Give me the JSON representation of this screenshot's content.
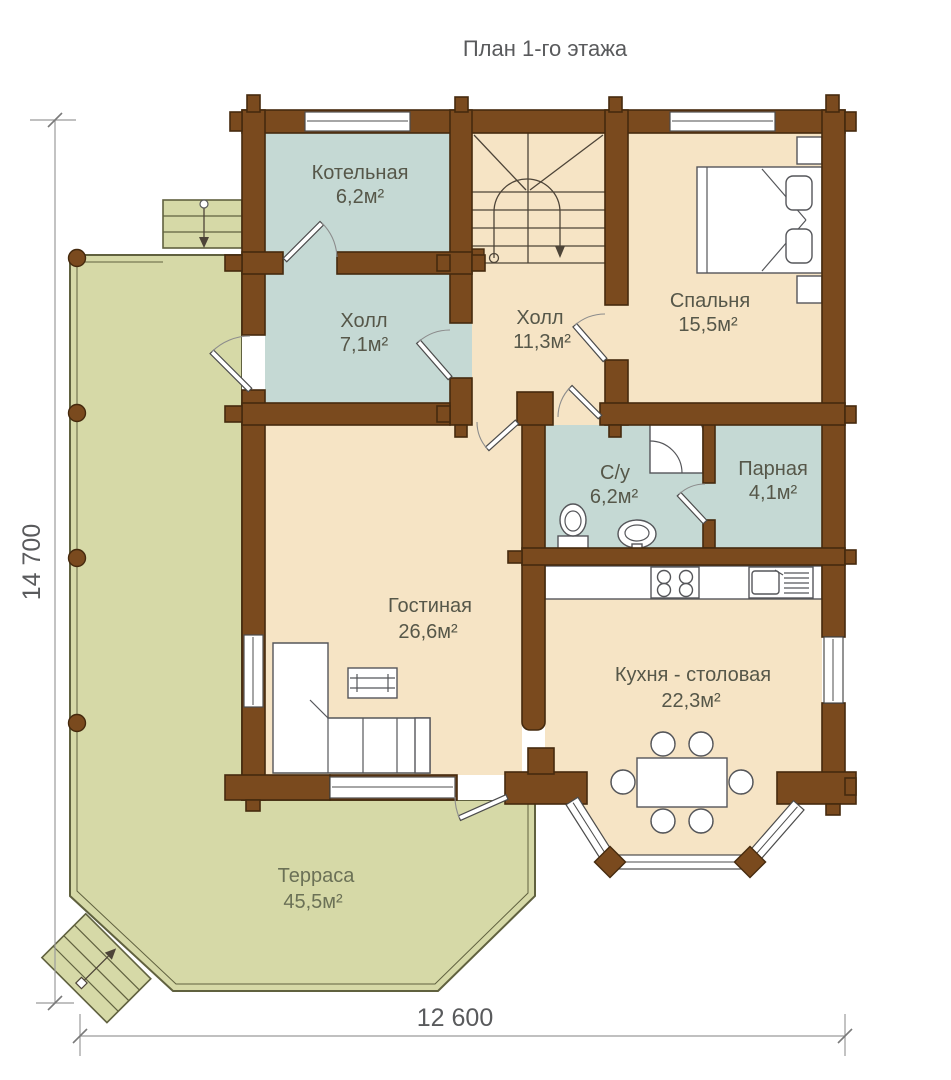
{
  "title": "План 1-го этажа",
  "rooms": [
    {
      "name": "Котельная",
      "area": "6,2м²"
    },
    {
      "name": "Холл",
      "area": "7,1м²"
    },
    {
      "name": "Холл",
      "area": "11,3м²"
    },
    {
      "name": "Спальня",
      "area": "15,5м²"
    },
    {
      "name": "С/у",
      "area": "6,2м²"
    },
    {
      "name": "Парная",
      "area": "4,1м²"
    },
    {
      "name": "Гостиная",
      "area": "26,6м²"
    },
    {
      "name": "Кухня - столовая",
      "area": "22,3м²"
    },
    {
      "name": "Терраса",
      "area": "45,5м²"
    }
  ],
  "dimensions": {
    "vertical": "14 700",
    "horizontal": "12 600"
  },
  "colors": {
    "wall-fill": "#7a4a1e",
    "wall-stroke": "#452a0e",
    "floor-beige": "#f6e4c5",
    "floor-teal": "#c5d9d4",
    "terrace-fill": "#d6d9a7",
    "terrace-stroke": "#60613f",
    "room-text": "#565749",
    "terrace-text": "#6b7156",
    "dim-text": "#595a5c",
    "furn-stroke": "#55565a",
    "stair-stroke": "#4d4438"
  }
}
